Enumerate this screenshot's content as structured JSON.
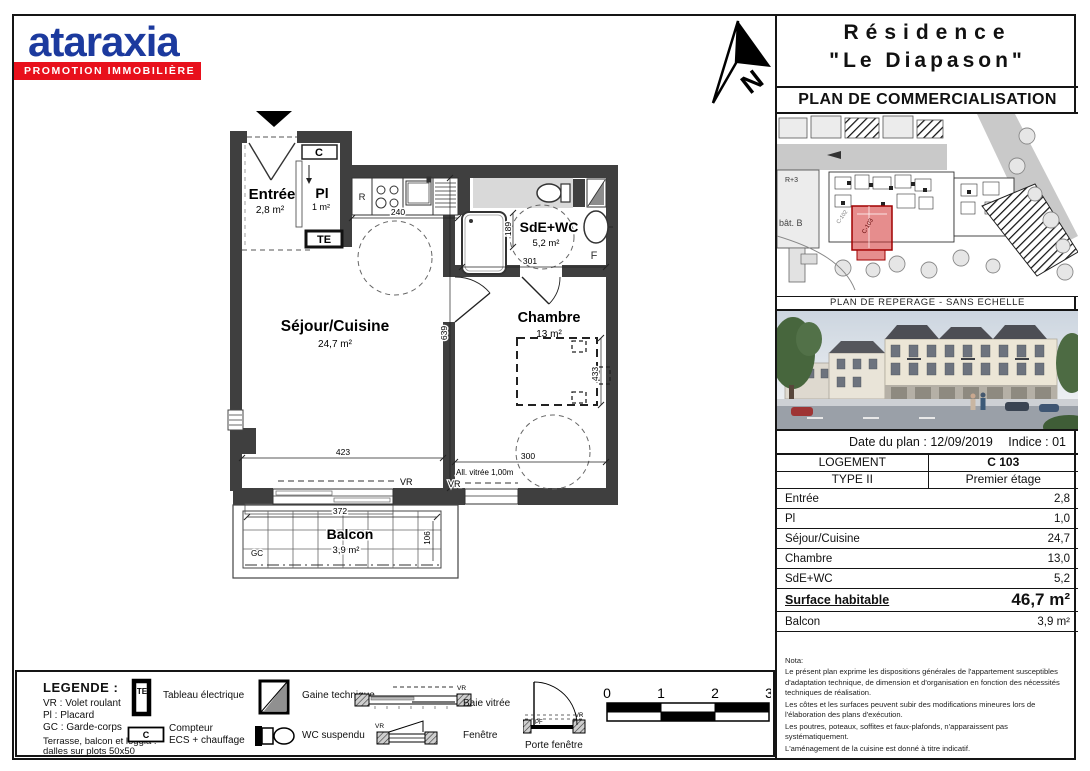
{
  "logo": {
    "brand": "ataraxia",
    "tagline": "PROMOTION IMMOBILIÈRE"
  },
  "north": {
    "label": "N"
  },
  "title_block": {
    "line1": "Résidence",
    "line2": "\"Le Diapason\"",
    "subtitle": "PLAN DE COMMERCIALISATION"
  },
  "site_plan": {
    "caption": "PLAN DE REPERAGE - SANS ECHELLE",
    "building_label": "bât. B",
    "floors_label": "R+3",
    "unit_label": "C-103",
    "unit2_label": "C-102"
  },
  "info_bar": {
    "date_label": "Date du plan :",
    "date_value": "12/09/2019",
    "indice_label": "Indice :",
    "indice_value": "01"
  },
  "unit_table": {
    "header_rows": [
      {
        "label": "LOGEMENT",
        "value": "C 103"
      },
      {
        "label": "TYPE II",
        "value": "Premier étage"
      }
    ],
    "area_rows": [
      {
        "label": "Entrée",
        "value": "2,8"
      },
      {
        "label": "Pl",
        "value": "1,0"
      },
      {
        "label": "Séjour/Cuisine",
        "value": "24,7"
      },
      {
        "label": "Chambre",
        "value": "13,0"
      },
      {
        "label": "SdE+WC",
        "value": "5,2"
      }
    ],
    "surface_row": {
      "label": "Surface habitable",
      "value": "46,7 m²"
    },
    "balcony_row": {
      "label": "Balcon",
      "value": "3,9 m²"
    }
  },
  "plan": {
    "rooms": {
      "entree": {
        "name": "Entrée",
        "area": "2,8 m²"
      },
      "placard": {
        "name": "Pl",
        "area": "1 m²"
      },
      "sejour": {
        "name": "Séjour/Cuisine",
        "area": "24,7 m²"
      },
      "sde": {
        "name": "SdE+WC",
        "area": "5,2 m²"
      },
      "chambre": {
        "name": "Chambre",
        "area": "13 m²"
      },
      "balcon": {
        "name": "Balcon",
        "area": "3,9 m²"
      }
    },
    "dims": {
      "kitchen_w": "240",
      "sde_w": "301",
      "sde_h": "189",
      "sejour_w": "423",
      "sejour_h": "639",
      "chambre_w": "300",
      "chambre_h": "433",
      "balcon_w": "372",
      "balcon_d": "106"
    },
    "tags": {
      "vr": "VR",
      "gc": "GC",
      "te": "TE",
      "c": "C",
      "r": "R",
      "f": "F",
      "pf": "PF",
      "allege": "All. vitrée 1,00m"
    }
  },
  "legend": {
    "title": "LEGENDE :",
    "abbr1": "VR : Volet roulant",
    "abbr2": "Pl : Placard",
    "abbr3": "GC : Garde-corps",
    "terrasse1": "Terrasse, balcon et loggia :",
    "terrasse2": "dalles sur plots 50x50",
    "tableau": "Tableau électrique",
    "compteur1": "Compteur",
    "compteur2": "ECS + chauffage",
    "gaine": "Gaine technique",
    "wc": "WC suspendu",
    "baie": "Baie vitrée",
    "fenetre": "Fenêtre",
    "porte": "Porte fenêtre"
  },
  "scale_bar": {
    "t0": "0",
    "t1": "1",
    "t2": "2",
    "t3": "3"
  },
  "nota": {
    "title": "Nota:",
    "lines": [
      "Le présent plan exprime les dispositions générales de l'appartement susceptibles d'adaptation technique, de dimension et d'organisation en fonction des nécessités techniques de réalisation.",
      "Les côtes et les surfaces peuvent subir des modifications mineures lors de l'élaboration des plans d'exécution.",
      "Les poutres, poteaux, soffites et faux-plafonds, n'apparaissent pas systématiquement.",
      "L'aménagement de la cuisine est donné à titre indicatif."
    ]
  }
}
